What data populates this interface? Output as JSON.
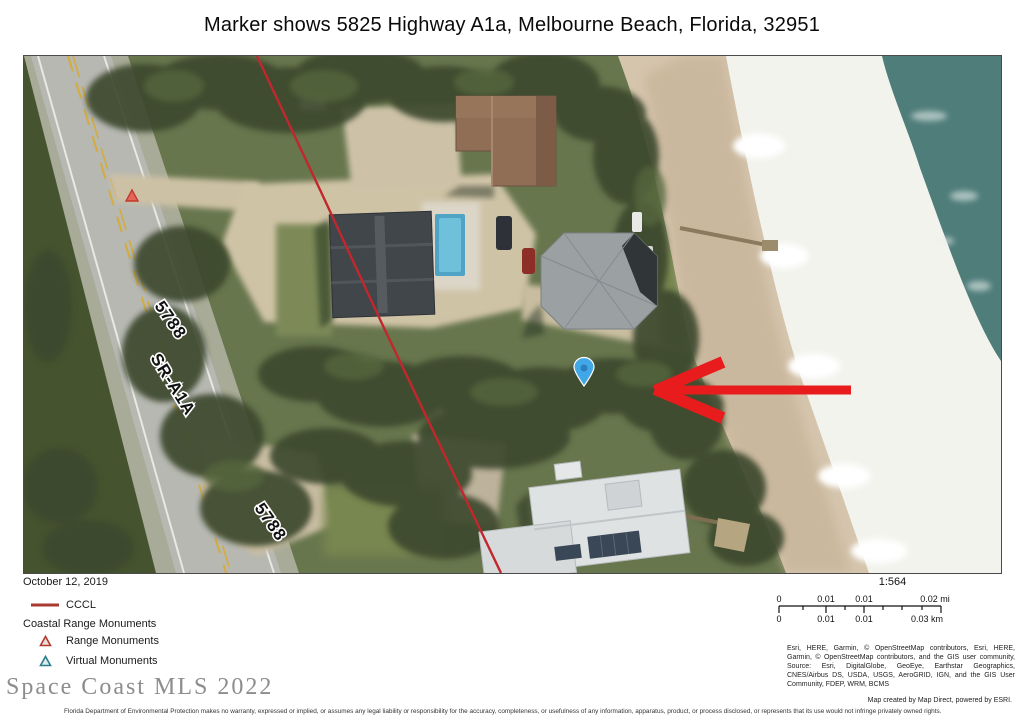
{
  "page": {
    "title": "Marker shows 5825 Highway A1a, Melbourne Beach, Florida, 32951"
  },
  "map": {
    "road_label": "SR-A1A",
    "street_number_upper": "5788",
    "street_number_lower": "5788",
    "marker": "location-pin",
    "colors": {
      "cccl_red": "#c1272d",
      "arrow_red": "#e81c1c",
      "marker_blue": "#41a7e6",
      "marker_blue_dark": "#2b7fc0",
      "range_monument_red": "#c2392b",
      "ocean_teal": "#4f7d7a"
    }
  },
  "legend": {
    "date": "October 12, 2019",
    "cccl_label": "CCCL",
    "cccl_color": "#a83a32",
    "group_title": "Coastal Range Monuments",
    "items": [
      {
        "label": "Range Monuments",
        "color": "#b03a2e"
      },
      {
        "label": "Virtual Monuments",
        "color": "#2a7e8c"
      }
    ]
  },
  "scale": {
    "ratio": "1:564",
    "mi_ticks": [
      "0",
      "0.01",
      "0.01",
      "0.02 mi"
    ],
    "km_ticks": [
      "0",
      "0.01",
      "0.01",
      "0.03 km"
    ]
  },
  "attribution": {
    "text": "Esri, HERE, Garmin, © OpenStreetMap contributors, Esri, HERE, Garmin, © OpenStreetMap contributors, and the GIS user community, Source: Esri, DigitalGlobe, GeoEye, Earthstar Geographics, CNES/Airbus DS, USDA, USGS, AeroGRID, IGN, and the GIS User Community, FDEP, WRM, BCMS"
  },
  "watermark": {
    "text": "Space Coast MLS 2022"
  },
  "footer": {
    "credit": "Map created by Map Direct, powered by ESRI.",
    "disclaimer": "Florida Department of Environmental Protection makes no warranty, expressed or implied, or assumes any legal liability or responsibility for the accuracy, completeness, or usefulness of any information, apparatus, product, or process disclosed, or represents that its use would not infringe privately owned rights."
  }
}
